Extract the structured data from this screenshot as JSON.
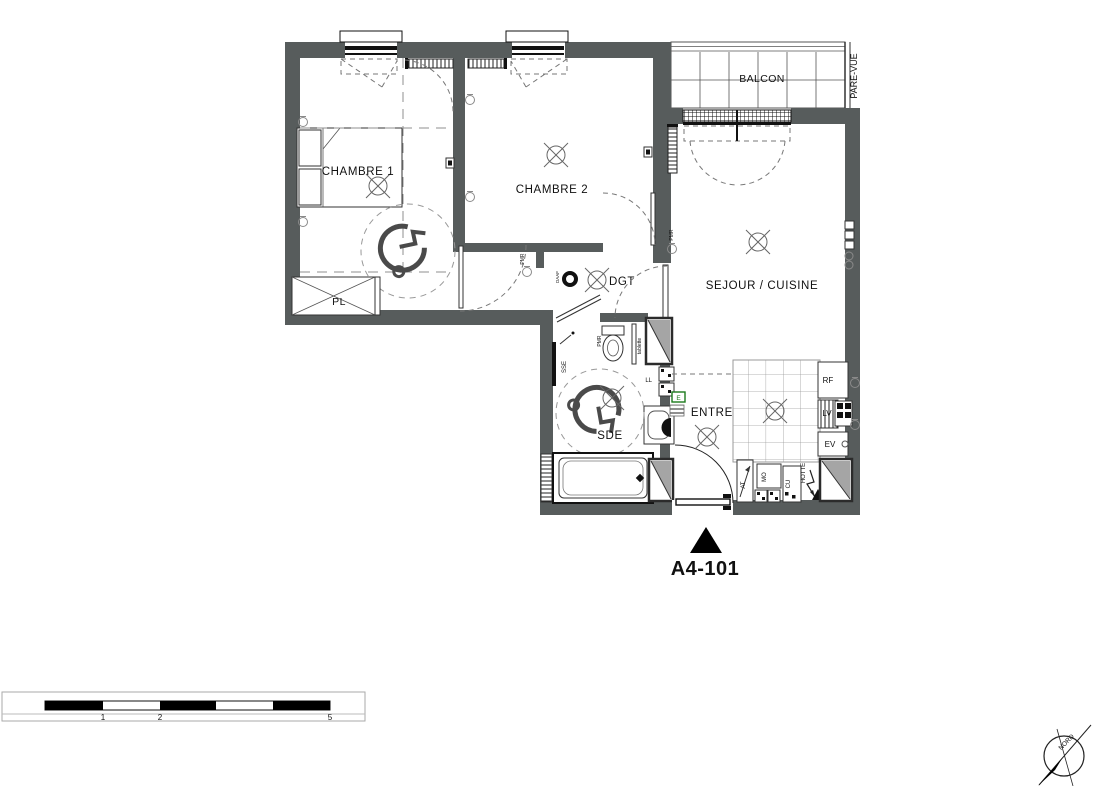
{
  "plan": {
    "unit_label": "A4-101",
    "rooms": {
      "chambre1": "CHAMBRE 1",
      "chambre2": "CHAMBRE 2",
      "sejour_cuisine": "SEJOUR / CUISINE",
      "balcon": "BALCON",
      "pare_vue": "PARE-VUE",
      "pl": "PL",
      "dgt": "DGT",
      "sde": "SDE",
      "entree": "ENTREE"
    },
    "labels": {
      "rf": "RF",
      "lv": "LV",
      "ev": "EV",
      "mo": "MO",
      "cu": "CU",
      "hotte": "HOTTE",
      "ll": "LL",
      "sse": "SSE",
      "at": "AT",
      "tablette": "tablette",
      "daaf": "DAAF",
      "pmr": "PMR",
      "e": "E"
    },
    "scale_bar": {
      "t1": "1",
      "t2": "2",
      "t5": "5"
    },
    "compass": {
      "north": "NORD"
    },
    "colors": {
      "wall": "#575c5c",
      "shaft_gray": "#a5a5a5",
      "accent_green": "#1d7a1d"
    }
  }
}
